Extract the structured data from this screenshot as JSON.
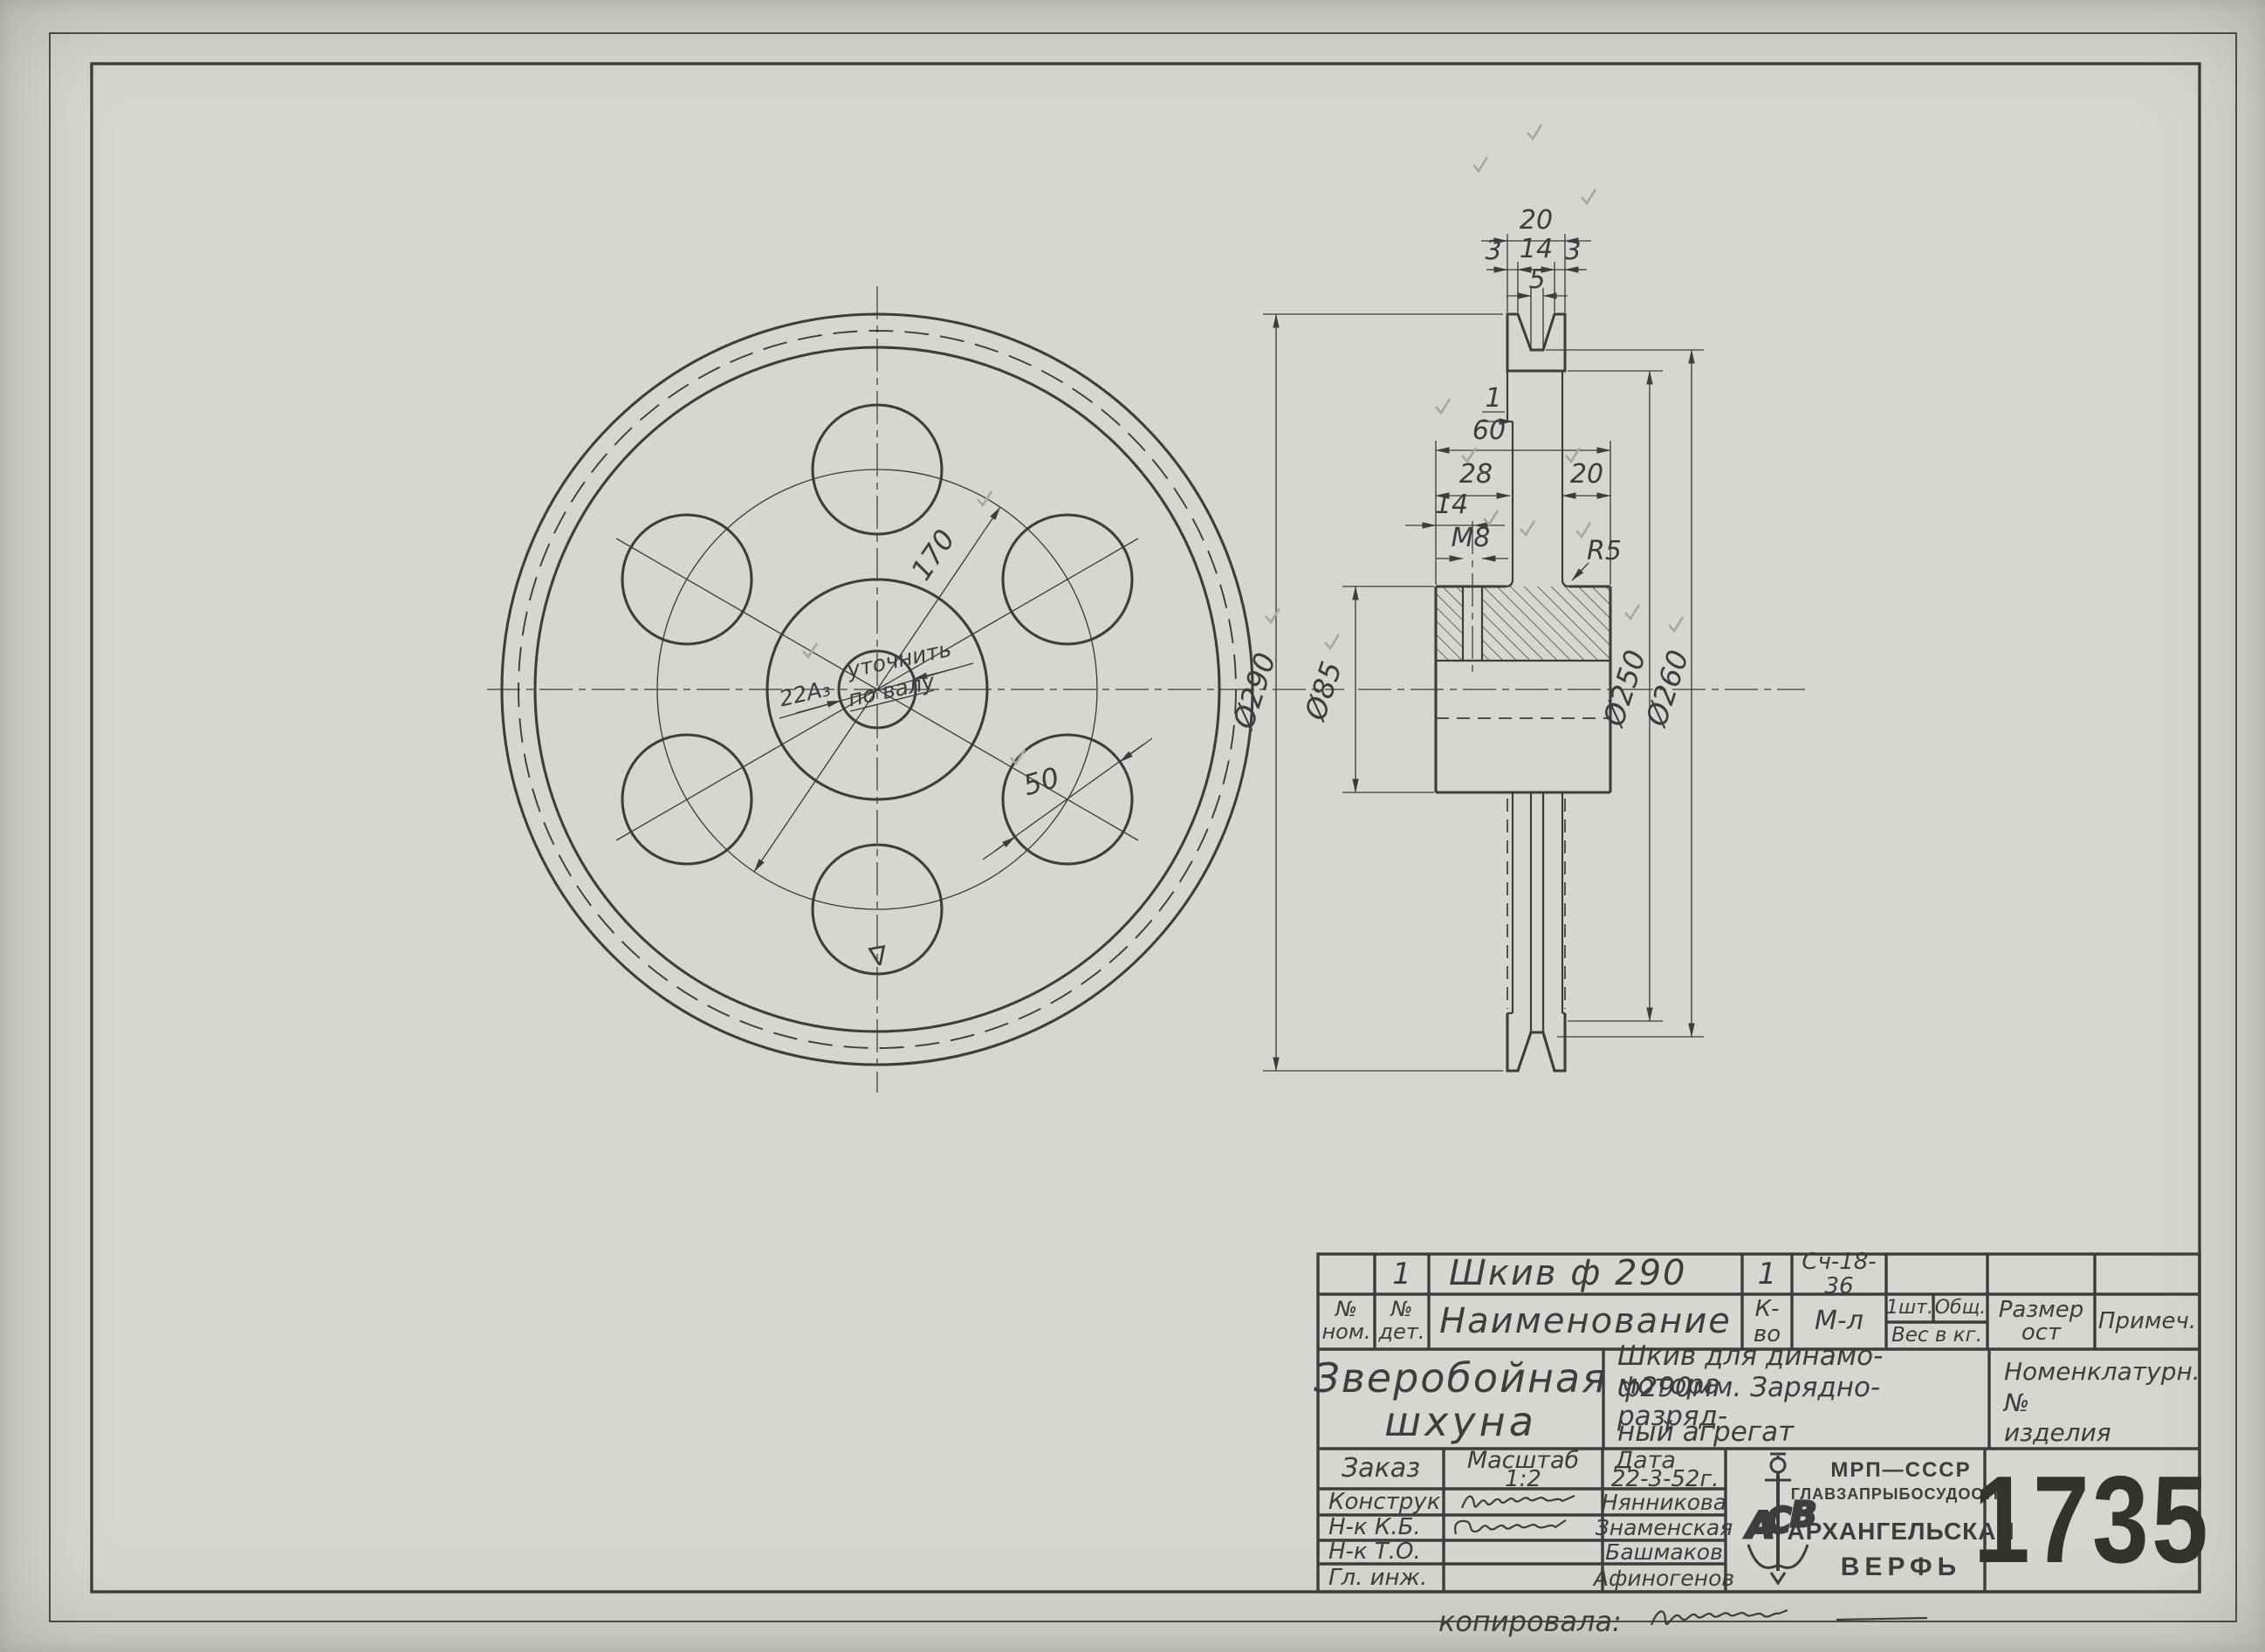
{
  "colors": {
    "paper": "#d7d6d2",
    "ink": "#3e3d3b",
    "pencil": "#a9a79f"
  },
  "front_view": {
    "dim_bolt_circle": "170",
    "dim_hole": "50",
    "bore_dim": "22А₃",
    "bore_note_line1": "уточнить",
    "bore_note_line2": "по валу",
    "surface_mark": "∇"
  },
  "side_view": {
    "dim_rim_width": "20",
    "dim_groove_edge_left": "3",
    "dim_groove_top": "14",
    "dim_groove_edge_right": "3",
    "dim_groove_bottom": "5",
    "dim_web_offset": "1",
    "dim_hub_length": "60",
    "dim_hub_left": "28",
    "dim_hub_right": "20",
    "dim_m8_offset": "14",
    "thread": "М8",
    "fillet": "R5",
    "dia_outer": "Ø290",
    "dia_hub": "Ø85",
    "dia_rim_inner": "Ø250",
    "dia_groove_bottom": "Ø260"
  },
  "title_block": {
    "row1": {
      "det_no": "1",
      "name": "Шкив ф 290",
      "qty": "1",
      "material": "Сч-18-36"
    },
    "headers": {
      "no_l1": "№",
      "no_l2": "ном.",
      "det_l1": "№",
      "det_l2": "дет.",
      "name": "Наименование",
      "qty": "К-во",
      "material": "М-л",
      "per_piece": "1шт.",
      "total": "Общ.",
      "weight": "Вес в кг.",
      "size_l1": "Размер",
      "size_l2": "ост",
      "note": "Примеч."
    },
    "project": {
      "line1": "Зверобойная",
      "line2": "шхуна"
    },
    "description": {
      "line1": "Шкив для динамо-мотора",
      "line2": "ф290мм. Зарядно-разряд-",
      "line3": "ный агрегат"
    },
    "nomenclature": {
      "line1": "Номенклатурн.",
      "line2": "№",
      "line3": "изделия"
    },
    "order_label": "Заказ",
    "scale_label": "Масштаб",
    "scale_value": "1:2",
    "date_label": "Дата",
    "date_value": "22-3-52г.",
    "signers": [
      {
        "role": "Конструк.",
        "name": "Нянникова"
      },
      {
        "role": "Н-к К.Б.",
        "name": "Знаменская"
      },
      {
        "role": "Н-к Т.О.",
        "name": "Башмаков"
      },
      {
        "role": "Гл. инж.",
        "name": "Афиногенов"
      }
    ],
    "org": {
      "line1": "МРП—СССР",
      "line2": "ГЛАВЗАПРЫБОСУДОСТР.",
      "line3": "АРХАНГЕЛЬСКАЯ",
      "line4": "ВЕРФЬ"
    },
    "drawing_number": "1735"
  },
  "footer": {
    "copied_label": "копировала:"
  }
}
